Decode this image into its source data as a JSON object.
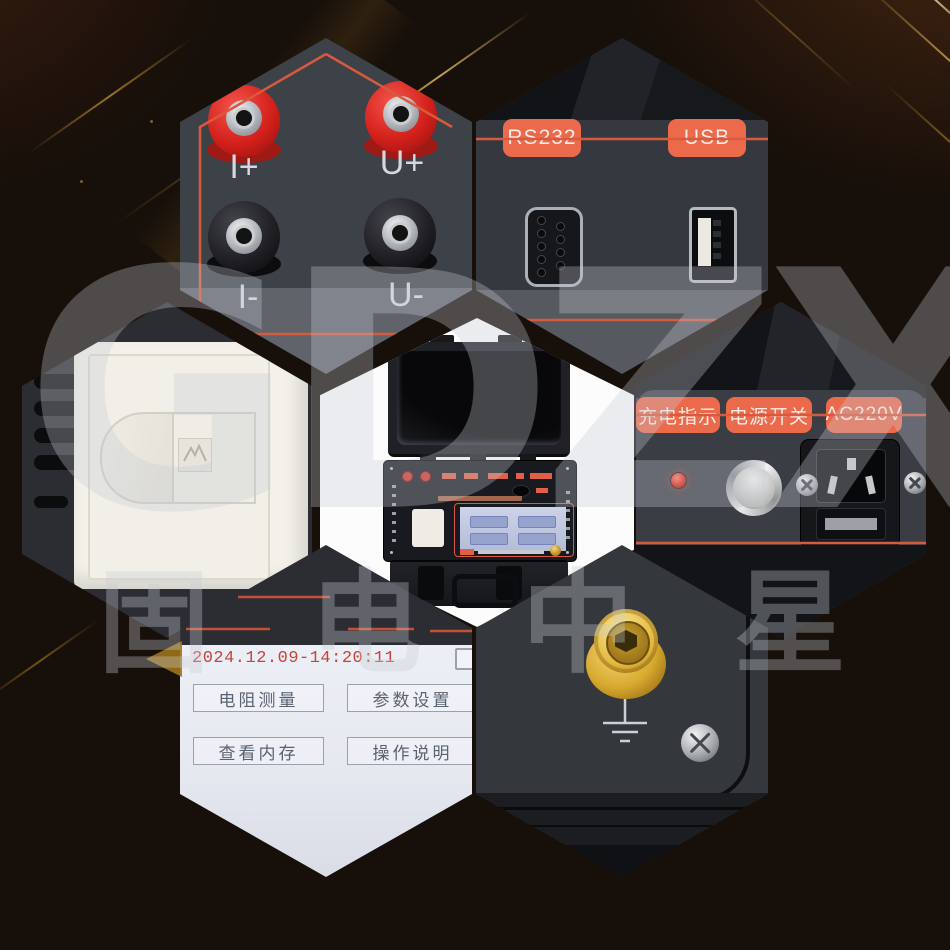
{
  "brand": {
    "logo_text": "GDZX",
    "brand_cn": "固电中星"
  },
  "terminals_panel": {
    "current_pos": "I+",
    "voltage_pos": "U+",
    "current_neg": "I-",
    "voltage_neg": "U-"
  },
  "ports_panel": {
    "rs232_label": "RS232",
    "usb_label": "USB"
  },
  "power_panel": {
    "charge_indicator_label": "充电指示",
    "power_switch_label": "电源开关",
    "ac_label": "AC220V"
  },
  "screen_panel": {
    "timestamp": "2024.12.09-14:20:11",
    "menu_buttons": [
      "电阻测量",
      "参数设置",
      "查看内存",
      "操作说明"
    ]
  },
  "colors": {
    "accent_orange": "#ec6a4c",
    "line_orange": "#d85a3e",
    "panel_gray": "#3a3d44",
    "led_red": "#ff4436",
    "led_green": "#5fbf3a",
    "terminal_gold": "#d9ab32",
    "screen_bg": "#e9ebf3",
    "background": "#170f0a"
  }
}
